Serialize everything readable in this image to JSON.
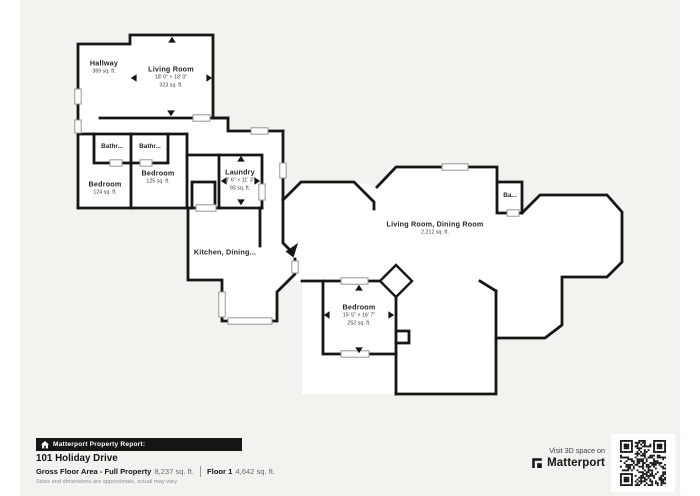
{
  "colors": {
    "background": "#f3f2ef",
    "wall": "#161616",
    "room_fill": "#ffffff",
    "banner_bg": "#161616",
    "banner_text": "#ffffff"
  },
  "floorplan": {
    "rooms": {
      "hallway": {
        "name": "Hallway",
        "area": "369 sq. ft."
      },
      "living_room": {
        "name": "Living Room",
        "dims": "18' 0\" × 18' 0\"",
        "area": "323 sq. ft."
      },
      "bathroom_1": {
        "name": "Bathr..."
      },
      "bathroom_2": {
        "name": "Bathr..."
      },
      "bedroom_1": {
        "name": "Bedroom",
        "area": "124 sq. ft."
      },
      "bedroom_2": {
        "name": "Bedroom",
        "area": "125 sq. ft."
      },
      "laundry": {
        "name": "Laundry",
        "dims": "8' 6\" × 11' 3\"",
        "area": "93 sq. ft."
      },
      "kitchen_dining": {
        "name": "Kitchen, Dining..."
      },
      "living_dining": {
        "name": "Living Room, Dining Room",
        "area": "2,212 sq. ft."
      },
      "bath_small": {
        "name": "Ba..."
      },
      "bedroom_3": {
        "name": "Bedroom",
        "dims": "15' 5\" × 16' 7\"",
        "area": "252 sq. ft."
      }
    }
  },
  "report": {
    "banner": "Matterport Property Report:",
    "address": "101 Holiday Drive",
    "gross_label": "Gross Floor Area - Full Property",
    "gross_value": "8,237 sq. ft.",
    "floor_label": "Floor 1",
    "floor_value": "4,642 sq. ft.",
    "disclaimer": "Sizes and dimensions are approximate, actual may vary"
  },
  "promo": {
    "visit": "Visit 3D space on",
    "brand": "Matterport"
  }
}
